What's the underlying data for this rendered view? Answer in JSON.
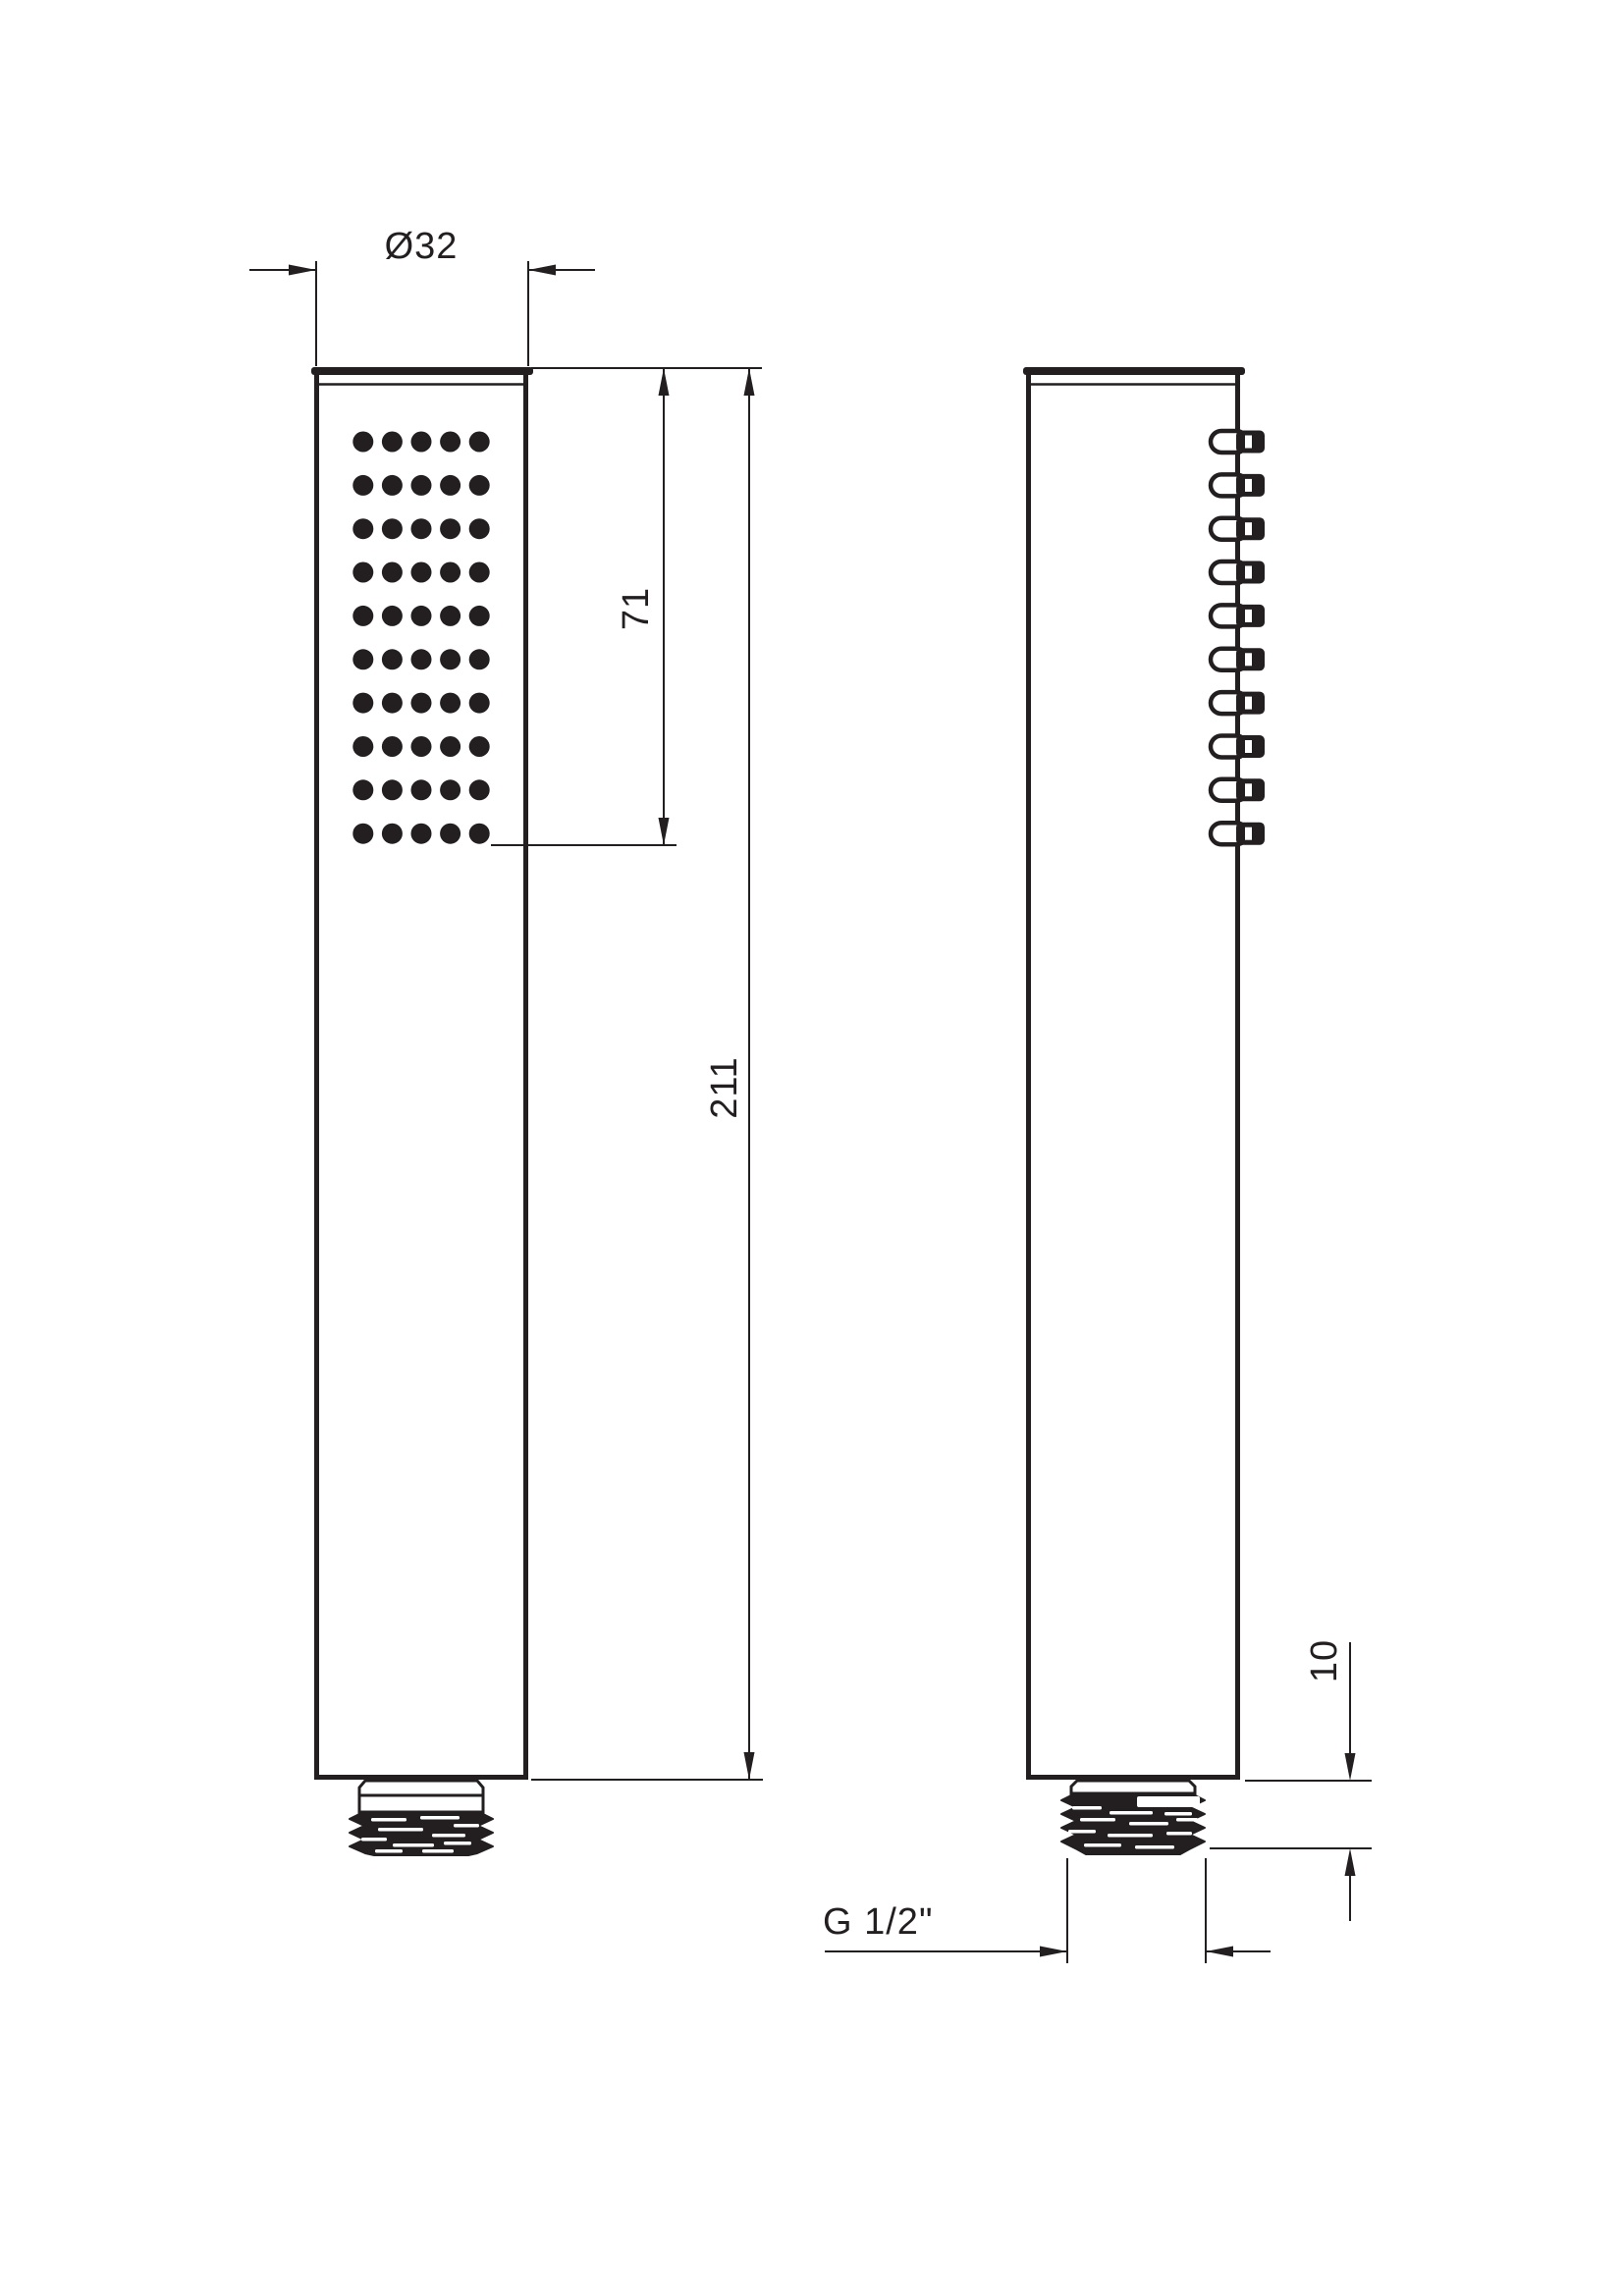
{
  "colors": {
    "line": "#231f20",
    "background": "#ffffff"
  },
  "dimensions": {
    "head_diameter": "Ø32",
    "spray_face_length": "71",
    "total_length": "211",
    "thread_length": "10",
    "thread_type": "G 1/2\""
  },
  "front_view": {
    "spray_grid": {
      "rows": 10,
      "columns": 5
    }
  },
  "side_view": {
    "nozzle_count": 10
  }
}
